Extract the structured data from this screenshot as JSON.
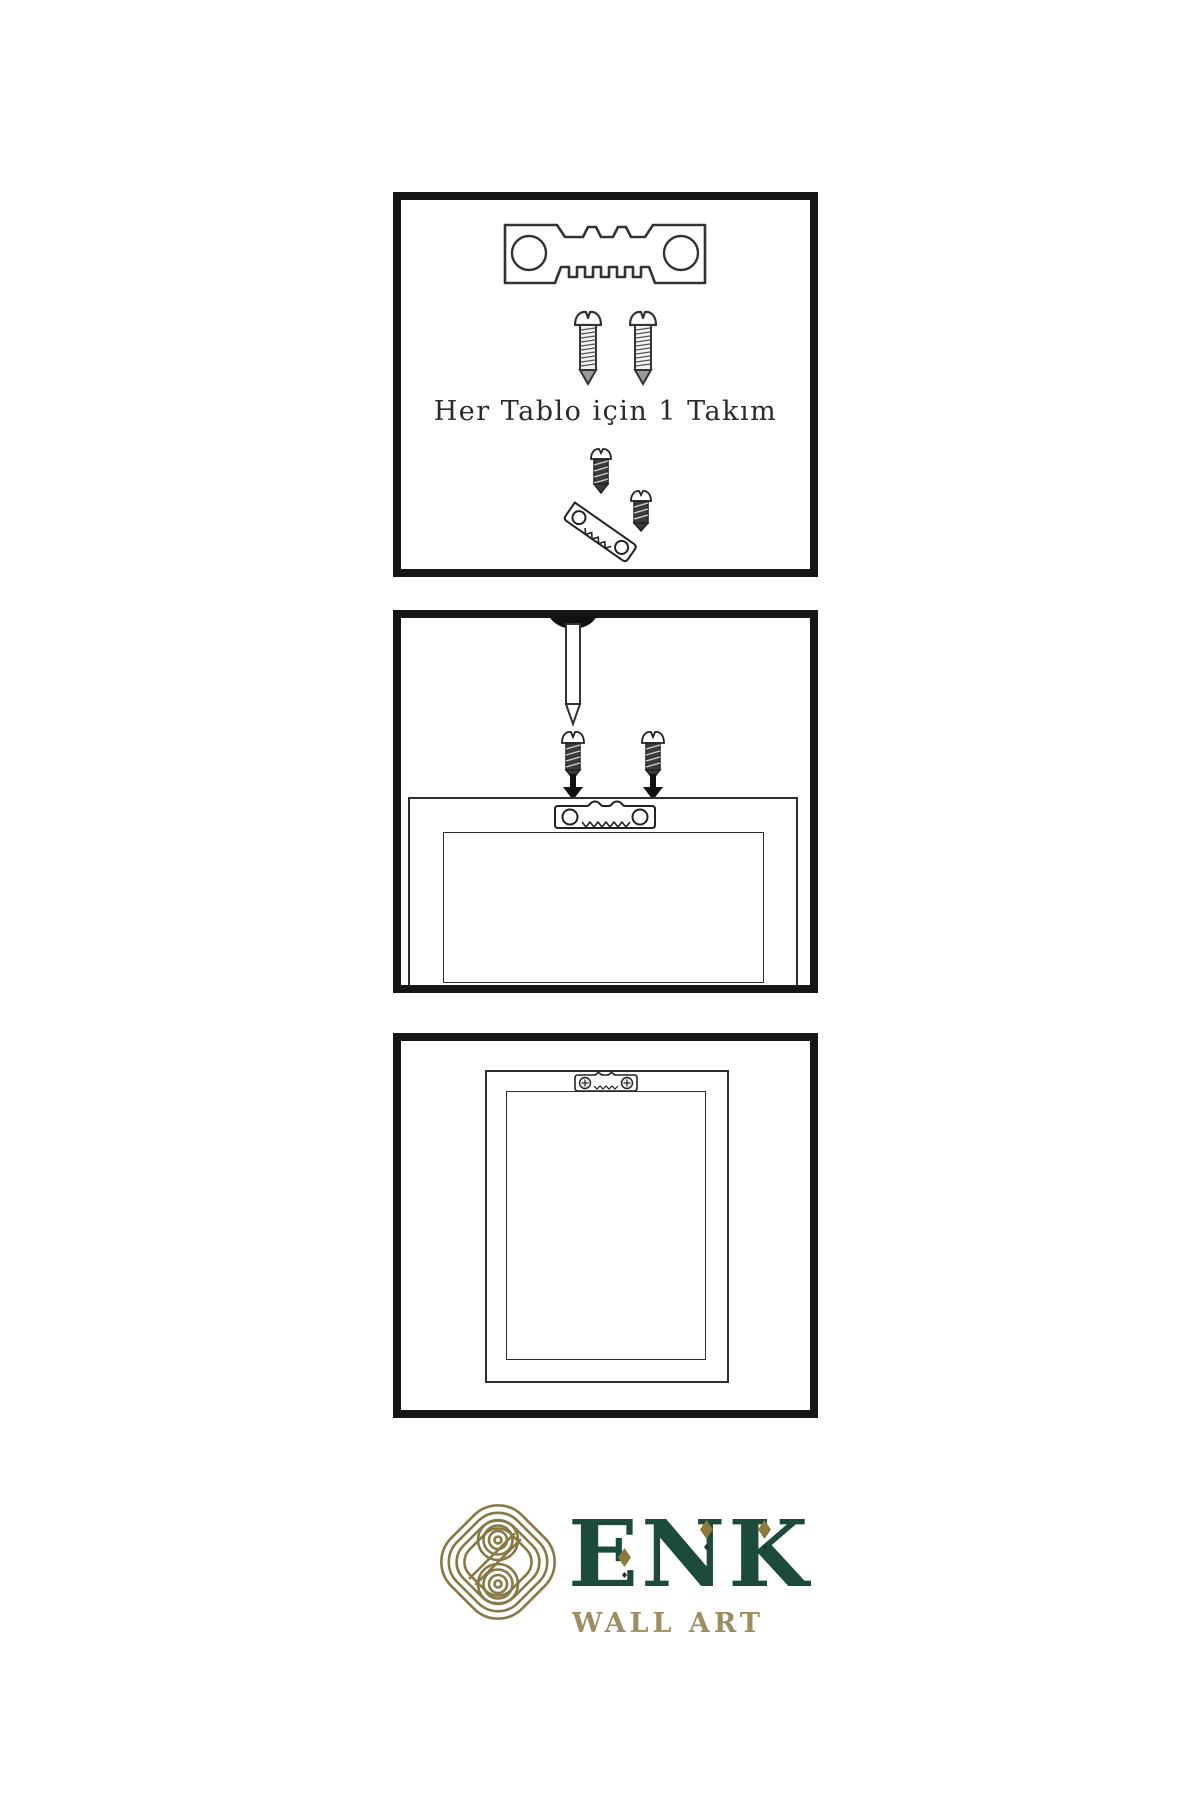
{
  "page": {
    "width": 1200,
    "height": 1800,
    "background": "#ffffff"
  },
  "colors": {
    "panel_border": "#161616",
    "line_art": "#333333",
    "dark_metal": "#3b3b3b",
    "brand_green": "#1c4a3b",
    "brand_gold": "#8c7a3d",
    "brand_tan": "#9c8e62",
    "knot_gold": "#867946"
  },
  "panels": {
    "kit": {
      "caption": "Her Tablo için 1 Takım",
      "icons": [
        "sawtooth-hanger-icon",
        "screw-icon",
        "screw-icon",
        "screw-icon",
        "angled-sawtooth-hanger-icon",
        "screw-icon"
      ]
    },
    "install": {
      "icons": [
        "wall-nail-icon",
        "dark-screw-icon",
        "dark-screw-icon",
        "down-arrow-icon",
        "down-arrow-icon",
        "sawtooth-hanger-icon",
        "frame-back-outline",
        "frame-back-inner-outline"
      ]
    },
    "mounted": {
      "icons": [
        "frame-back-outline",
        "frame-back-inner-outline",
        "mounted-sawtooth-hanger-icon"
      ]
    }
  },
  "brand": {
    "name": "ENK",
    "subtitle": "WALL ART",
    "logo": "interlaced-knot-logo",
    "ornaments": [
      "diamond-icon",
      "diamond-icon",
      "diamond-icon",
      "dot-icon",
      "dot-icon",
      "dot-icon"
    ]
  }
}
